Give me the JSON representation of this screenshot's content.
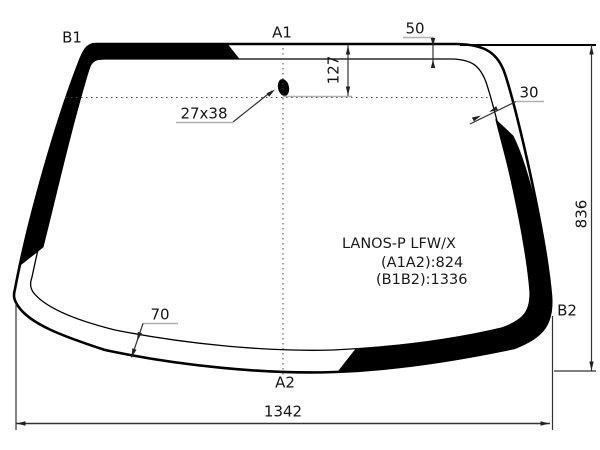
{
  "watermark": "АВТОТРЕЙД",
  "part": {
    "name": "LANOS-P LFW/X",
    "a1a2": "(A1A2):824",
    "b1b2": "(B1B2):1336"
  },
  "corner_labels": {
    "b1": "B1",
    "a1": "A1",
    "a2": "A2",
    "b2": "B2"
  },
  "dimensions": {
    "top_band_width": "50",
    "header_offset": "127",
    "side_band_width": "30",
    "bottom_band_width": "70",
    "mount_size": "27x38",
    "height": "836",
    "width": "1342"
  },
  "colors": {
    "line": "#000000",
    "dimension": "#333333",
    "underline": "#b0b0b0",
    "watermark_outline": "#d2d2d2",
    "background": "#ffffff"
  }
}
